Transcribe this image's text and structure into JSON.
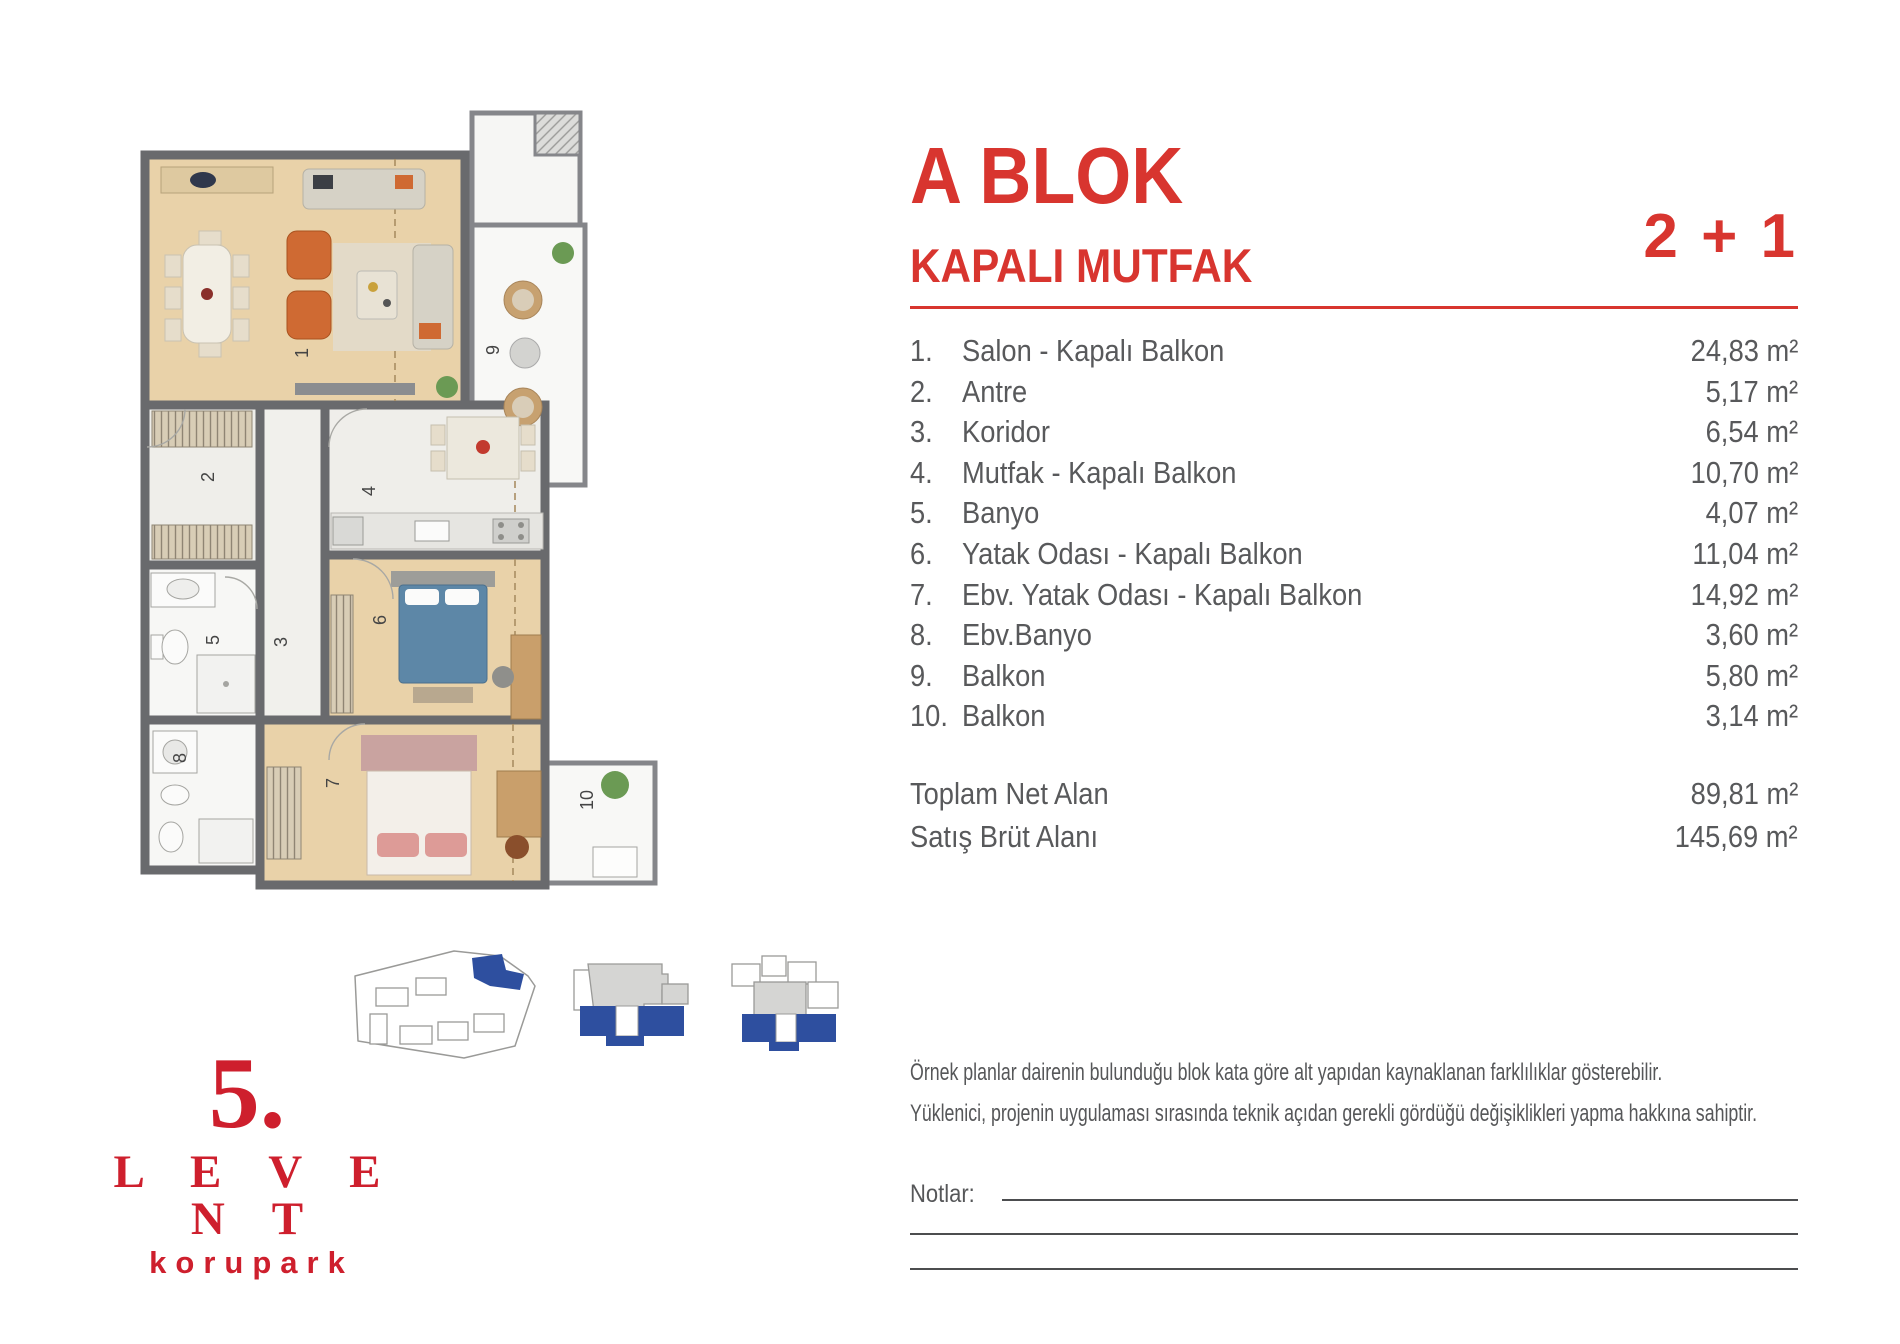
{
  "header": {
    "block_title": "A BLOK",
    "subtitle": "KAPALI MUTFAK",
    "unit_type": "2 + 1"
  },
  "rooms": [
    {
      "no": "1.",
      "name": "Salon - Kapalı Balkon",
      "area": "24,83 m²"
    },
    {
      "no": "2.",
      "name": "Antre",
      "area": "5,17 m²"
    },
    {
      "no": "3.",
      "name": "Koridor",
      "area": "6,54 m²"
    },
    {
      "no": "4.",
      "name": "Mutfak - Kapalı Balkon",
      "area": "10,70 m²"
    },
    {
      "no": "5.",
      "name": "Banyo",
      "area": "4,07 m²"
    },
    {
      "no": "6.",
      "name": "Yatak Odası - Kapalı Balkon",
      "area": "11,04 m²"
    },
    {
      "no": "7.",
      "name": "Ebv. Yatak Odası - Kapalı Balkon",
      "area": "14,92 m²"
    },
    {
      "no": "8.",
      "name": "Ebv.Banyo",
      "area": "3,60 m²"
    },
    {
      "no": "9.",
      "name": "Balkon",
      "area": "5,80 m²"
    },
    {
      "no": "10.",
      "name": "Balkon",
      "area": "3,14 m²"
    }
  ],
  "totals": [
    {
      "label": "Toplam Net Alan",
      "value": "89,81 m²"
    },
    {
      "label": "Satış Brüt Alanı",
      "value": "145,69 m²"
    }
  ],
  "disclaimer": {
    "line1": "Örnek planlar dairenin bulunduğu blok kata göre alt yapıdan kaynaklanan farklılıklar gösterebilir.",
    "line2": "Yüklenici, projenin uygulaması sırasında teknik açıdan gerekli gördüğü değişiklikleri yapma hakkına sahiptir."
  },
  "notes": {
    "label": "Notlar:"
  },
  "floor_plan": {
    "labels": [
      "1",
      "2",
      "3",
      "4",
      "5",
      "6",
      "7",
      "8",
      "9",
      "10"
    ]
  },
  "logo": {
    "number": "5.",
    "name": "L E V E N T",
    "subname": "korupark"
  },
  "colors": {
    "accent_red": "#d8352f",
    "logo_red": "#ce1f2d",
    "text_gray": "#58595b",
    "diagram_blue": "#2e4f9f",
    "wall_gray": "#696a6d",
    "wood_floor": "#e9d2a9"
  }
}
